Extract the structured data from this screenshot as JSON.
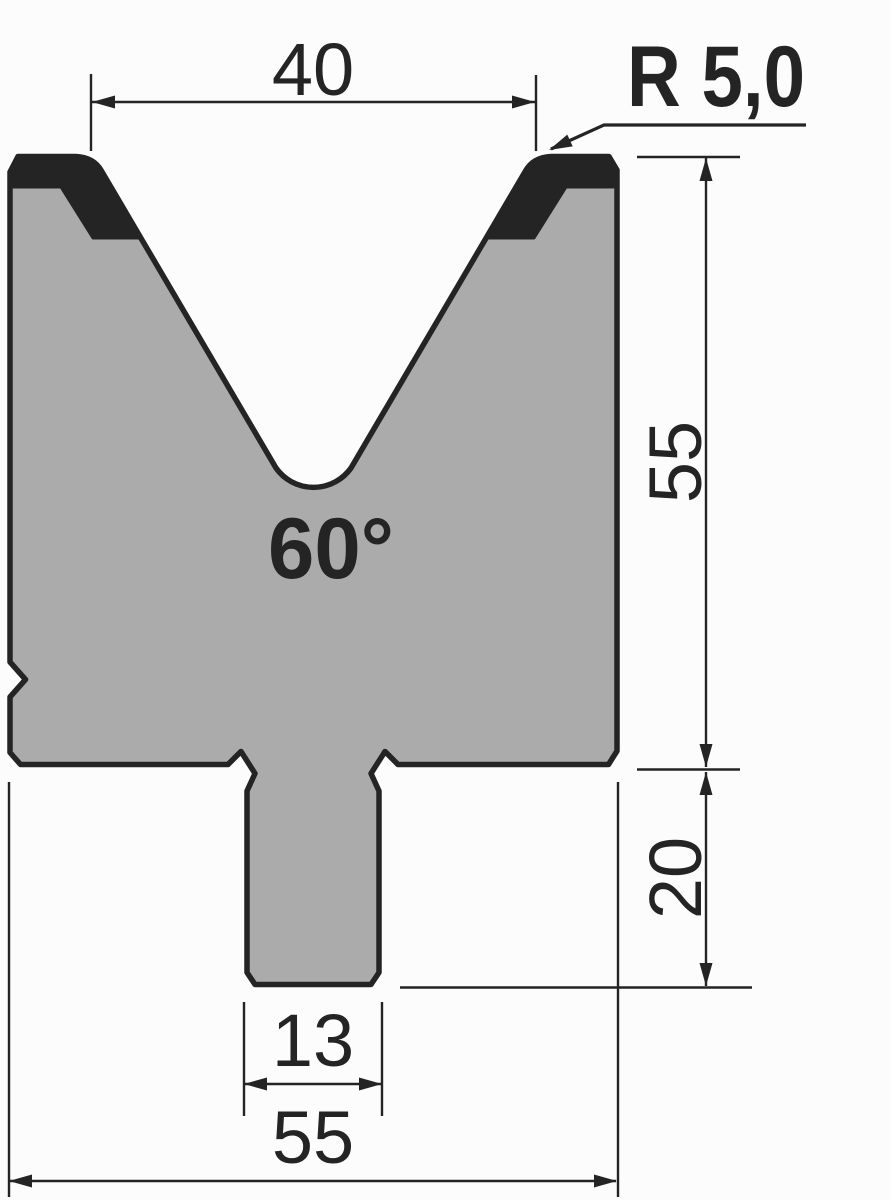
{
  "drawing": {
    "type": "technical-drawing",
    "subject": "press-brake V-die cross-section",
    "background": "#fcfcfc",
    "body_fill": "#ababab",
    "line_color": "#242424",
    "hardened_zone_color": "#242424",
    "labels": {
      "top_width": "40",
      "corner_radius": "R 5,0",
      "vee_angle": "60°",
      "body_height": "55",
      "tang_height": "20",
      "tang_width": "13",
      "base_width": "55"
    }
  }
}
